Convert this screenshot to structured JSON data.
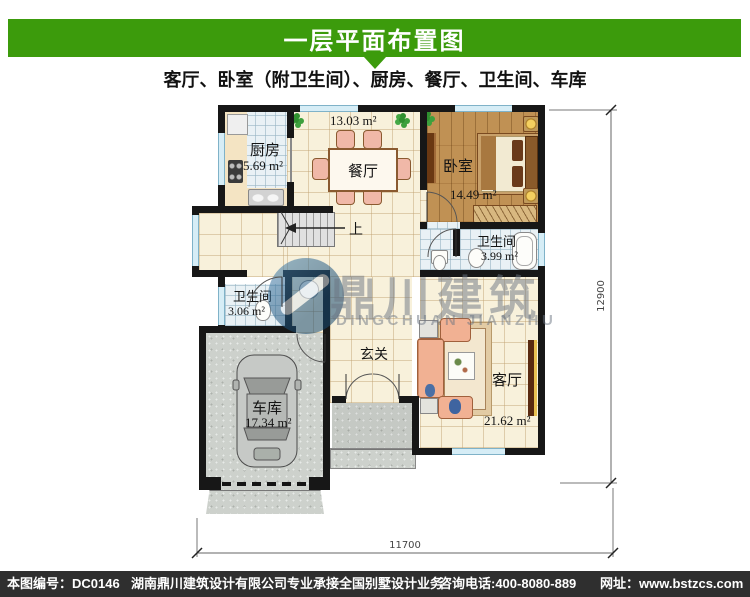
{
  "header": {
    "title": "一层平面布置图"
  },
  "subtitle": "客厅、卧室（附卫生间）、厨房、餐厅、卫生间、车库",
  "plan": {
    "rooms": {
      "kitchen": {
        "name": "厨房",
        "area": "5.69 m²"
      },
      "dining": {
        "name": "餐厅",
        "area": "13.03 m²"
      },
      "bedroom": {
        "name": "卧室",
        "area": "14.49 m²"
      },
      "bath_master": {
        "name": "卫生间",
        "area": "3.99 m²"
      },
      "bath_common": {
        "name": "卫生间",
        "area": "3.06 m²"
      },
      "garage": {
        "name": "车库",
        "area": "17.34 m²"
      },
      "entry": {
        "name": "玄关"
      },
      "living": {
        "name": "客厅",
        "area": "21.62 m²"
      }
    },
    "stairs_label": "上",
    "dimensions": {
      "bottom": "11700",
      "right": "12900"
    }
  },
  "watermark": {
    "cn": "鼎川建筑",
    "en": "DINGCHUAN JIANZHU"
  },
  "footer": {
    "code": "本图编号：DC0146",
    "company": "湖南鼎川建筑设计有限公司专业承接全国别墅设计业务",
    "phone": "咨询电话:400-8080-889",
    "site": "网址：www.bstzcs.com"
  },
  "colors": {
    "header_green": "#3c9b0c",
    "footer_bg": "#2f2f2f",
    "wall": "#171717",
    "window": "#d6edf6"
  }
}
